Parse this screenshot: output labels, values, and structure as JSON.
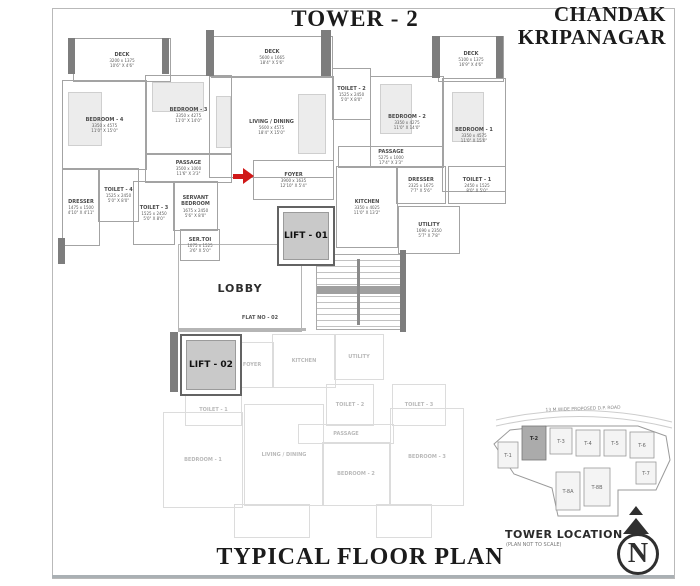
{
  "header": {
    "tower_title": "TOWER - 2",
    "brand_line1": "CHANDAK",
    "brand_line2": "KRIPANAGAR"
  },
  "footer": {
    "plan_title": "TYPICAL FLOOR PLAN"
  },
  "core": {
    "lift_01": "LIFT - 01",
    "lift_02": "LIFT - 02",
    "lobby": "LOBBY",
    "flat_no": "FLAT NO - 02"
  },
  "rooms": {
    "deck_left": {
      "name": "DECK",
      "mm": "3200 x 1375",
      "ft": "10'6\" X 4'6\""
    },
    "bedroom_4": {
      "name": "BEDROOM - 4",
      "mm": "3350 x 4575",
      "ft": "11'0\" X 15'0\""
    },
    "bedroom_3": {
      "name": "BEDROOM - 3",
      "mm": "3350 x 4275",
      "ft": "11'0\" X 14'0\""
    },
    "passage_left": {
      "name": "PASSAGE",
      "mm": "3500 x 1000",
      "ft": "11'6\" X 3'3\""
    },
    "toilet_4": {
      "name": "TOILET - 4",
      "mm": "1525 x 2450",
      "ft": "5'0\" X 8'0\""
    },
    "dresser_left": {
      "name": "DRESSER",
      "mm": "1475 x 1500",
      "ft": "4'10\" X 4'11\""
    },
    "toilet_3": {
      "name": "TOILET - 3",
      "mm": "1525 x 2450",
      "ft": "5'0\" X 8'0\""
    },
    "servant_bedroom": {
      "name": "SERVANT BEDROOM",
      "mm": "1675 x 2450",
      "ft": "5'6\" X 8'0\""
    },
    "ser_toi": {
      "name": "SER.TOI",
      "mm": "1075 x 1525",
      "ft": "3'6\" X 5'0\""
    },
    "deck_mid": {
      "name": "DECK",
      "mm": "5600 x 1665",
      "ft": "18'4\" X 5'6\""
    },
    "living_dining": {
      "name": "LIVING / DINING",
      "mm": "5600 x 4575",
      "ft": "18'4\" X 15'0\""
    },
    "foyer": {
      "name": "FOYER",
      "mm": "3900 x 1635",
      "ft": "12'10\" X 5'4\""
    },
    "toilet_2": {
      "name": "TOILET - 2",
      "mm": "1525 x 2450",
      "ft": "5'0\" X 8'0\""
    },
    "deck_right": {
      "name": "DECK",
      "mm": "5100 x 1375",
      "ft": "16'9\" X 4'6\""
    },
    "bedroom_2": {
      "name": "BEDROOM - 2",
      "mm": "3350 x 4275",
      "ft": "11'0\" X 14'0\""
    },
    "bedroom_1": {
      "name": "BEDROOM - 1",
      "mm": "3350 x 4575",
      "ft": "11'0\" X 15'0\""
    },
    "passage_right": {
      "name": "PASSAGE",
      "mm": "5275 x 1000",
      "ft": "17'4\" X 3'3\""
    },
    "dresser_right": {
      "name": "DRESSER",
      "mm": "2325 x 1675",
      "ft": "7'7\" X 5'6\""
    },
    "toilet_1": {
      "name": "TOILET - 1",
      "mm": "2450 x 1525",
      "ft": "8'0\" X 5'0\""
    },
    "kitchen": {
      "name": "KITCHEN",
      "mm": "3350 x 4025",
      "ft": "11'0\" X 13'2\""
    },
    "utility": {
      "name": "UTILITY",
      "mm": "1690 x 2350",
      "ft": "5'7\" X 7'8\""
    }
  },
  "faded_rooms": {
    "foyer": {
      "name": "FOYER"
    },
    "kitchen": {
      "name": "KITCHEN"
    },
    "utility": {
      "name": "UTILITY"
    },
    "toilet_1": {
      "name": "TOILET - 1"
    },
    "toilet_2": {
      "name": "TOILET - 2"
    },
    "toilet_3": {
      "name": "TOILET - 3"
    },
    "passage": {
      "name": "PASSAGE"
    },
    "bedroom_1": {
      "name": "BEDROOM - 1"
    },
    "living_dining": {
      "name": "LIVING / DINING"
    },
    "bedroom_2": {
      "name": "BEDROOM - 2"
    },
    "bedroom_3": {
      "name": "BEDROOM - 3"
    }
  },
  "map": {
    "title": "TOWER LOCATION",
    "subtitle": "(PLAN NOT TO SCALE)",
    "road_label": "13 M WIDE PROPOSED D.P. ROAD",
    "towers": [
      "T-1",
      "T-2",
      "T-3",
      "T-4",
      "T-5",
      "T-6",
      "T-7",
      "T-8A",
      "T-8B"
    ],
    "highlighted_tower": "T-2",
    "compass_n": "N"
  },
  "colors": {
    "accent_red": "#d01818",
    "wall_gray": "#7d7d7d",
    "highlight_gray": "#ababab"
  }
}
